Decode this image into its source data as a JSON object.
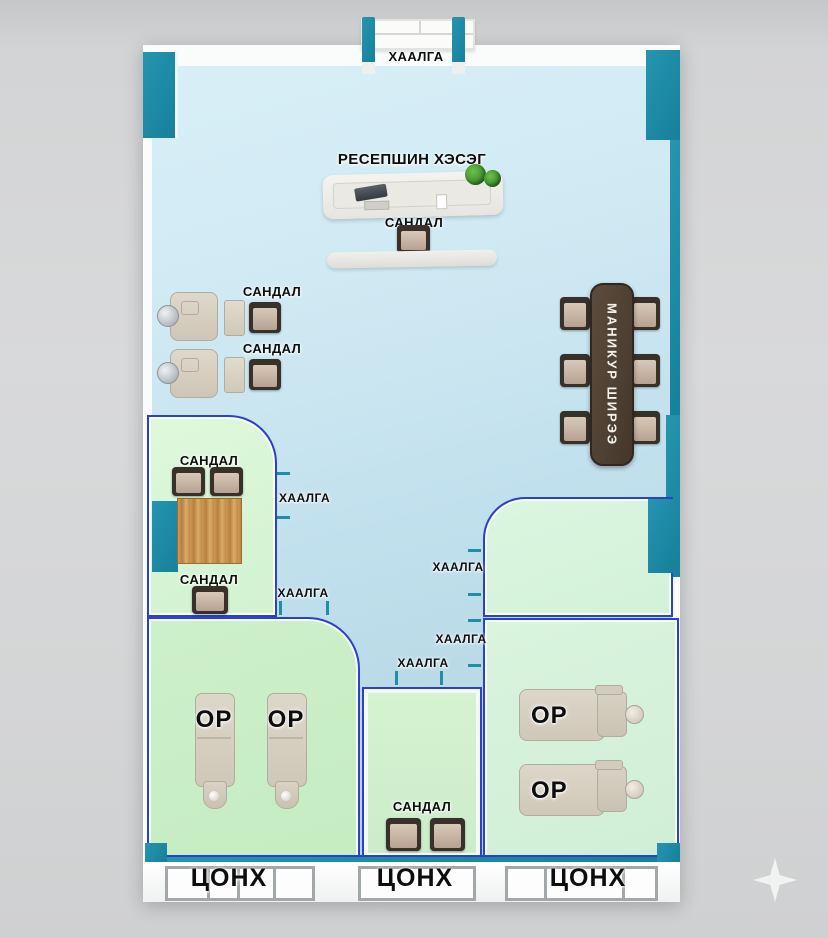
{
  "plan_type": "salon-floor-plan",
  "colors": {
    "wall_teal": "#1e89a4",
    "room_border_blue": "#2a41cf",
    "floor_blue": "#c6e4f0",
    "room_green": "#d2f0cd",
    "wood_table": "#c89a55",
    "manicure_table_brown": "#4e4034"
  },
  "entrance": {
    "door_label": "ХААЛГА"
  },
  "reception": {
    "area_label": "РЕСЕПШИН ХЭСЭГ",
    "chair_label": "САНДАЛ"
  },
  "styling_stations": {
    "chair_label_1": "САНДАЛ",
    "chair_label_2": "САНДАЛ"
  },
  "manicure": {
    "table_label": "МАНИКУР ШИРЭЭ"
  },
  "consult_room": {
    "chairs_top_label": "САНДАЛ",
    "chair_bottom_label": "САНДАЛ"
  },
  "doors": {
    "consult_side": "ХААЛГА",
    "massage_left": "ХААЛГА",
    "lounge_upper": "ХААЛГА",
    "lounge_lower": "ХААЛГА",
    "pedicure": "ХААЛГА"
  },
  "massage_room_left": {
    "bed_1": "ОР",
    "bed_2": "ОР"
  },
  "massage_room_right": {
    "bed_1": "ОР",
    "bed_2": "ОР"
  },
  "pedicure_room": {
    "chairs_label": "САНДАЛ"
  },
  "windows": {
    "left": "ЦОНХ",
    "middle": "ЦОНХ",
    "right": "ЦОНХ"
  }
}
